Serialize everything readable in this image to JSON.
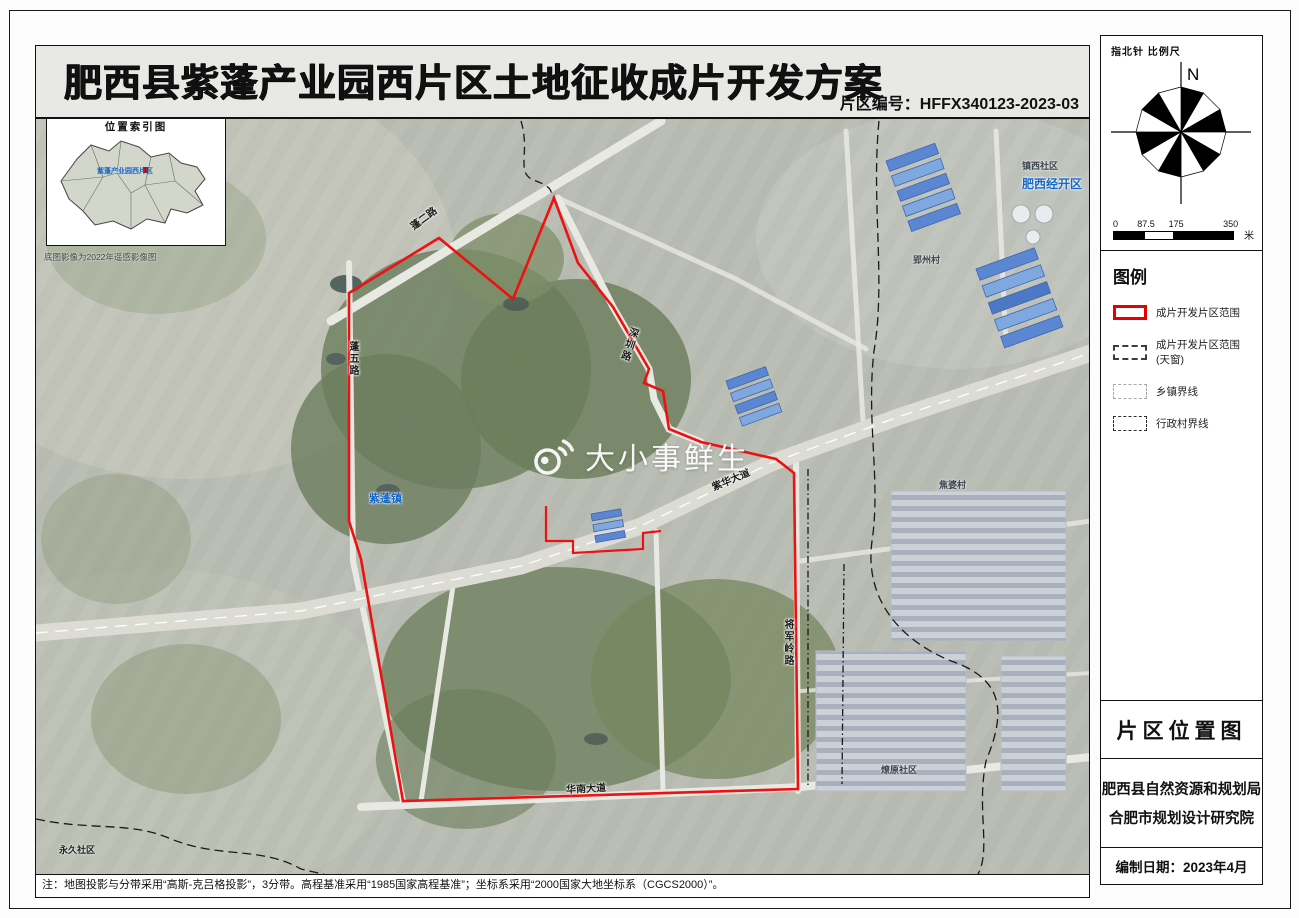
{
  "header": {
    "title": "肥西县紫蓬产业园西片区土地征收成片开发方案",
    "code": "片区编号：HFFX340123-2023-03"
  },
  "inset": {
    "title": "位置索引图",
    "site_label": "紫蓬产业园西片区",
    "caption": "底图影像为2022年遥感影像图"
  },
  "map": {
    "watermark": "大小事鲜生",
    "labels": {
      "road_peng2": "蓬二路",
      "road_peng5": "蓬五路",
      "road_shenzhen": "深圳路",
      "road_zihua": "紫华大道",
      "road_huanan": "华南大道",
      "road_jiangjunling": "将军岭路",
      "town_zipeng": "紫蓬镇",
      "community_zhenxi": "镇西社区",
      "area_feixi_edz": "肥西经开区",
      "village_yingzhou": "郢州村",
      "village_jiaopo": "焦婆村",
      "community_liaoyuan": "燎原社区",
      "community_yongjiu": "永久社区"
    }
  },
  "sidebar": {
    "compass_caption": "指北针  比例尺",
    "north": "N",
    "scale": {
      "ticks": [
        "0",
        "87.5",
        "175",
        "350"
      ],
      "unit": "米"
    },
    "legend": {
      "title": "图例",
      "items": [
        "成片开发片区范围",
        "成片开发片区范围(天窗)",
        "乡镇界线",
        "行政村界线"
      ]
    },
    "location_map_title": "片区位置图",
    "org_line1": "肥西县自然资源和规划局",
    "org_line2": "合肥市规划设计研究院",
    "date_line": "编制日期：2023年4月"
  },
  "footer": {
    "note": "注：地图投影与分带采用“高斯-克吕格投影”，3分带。高程基准采用“1985国家高程基准”；坐标系采用“2000国家大地坐标系（CGCS2000）”。"
  },
  "colors": {
    "boundary_red": "#e60000",
    "label_blue": "#1668c9",
    "satellite_base": "#b7bab0"
  }
}
